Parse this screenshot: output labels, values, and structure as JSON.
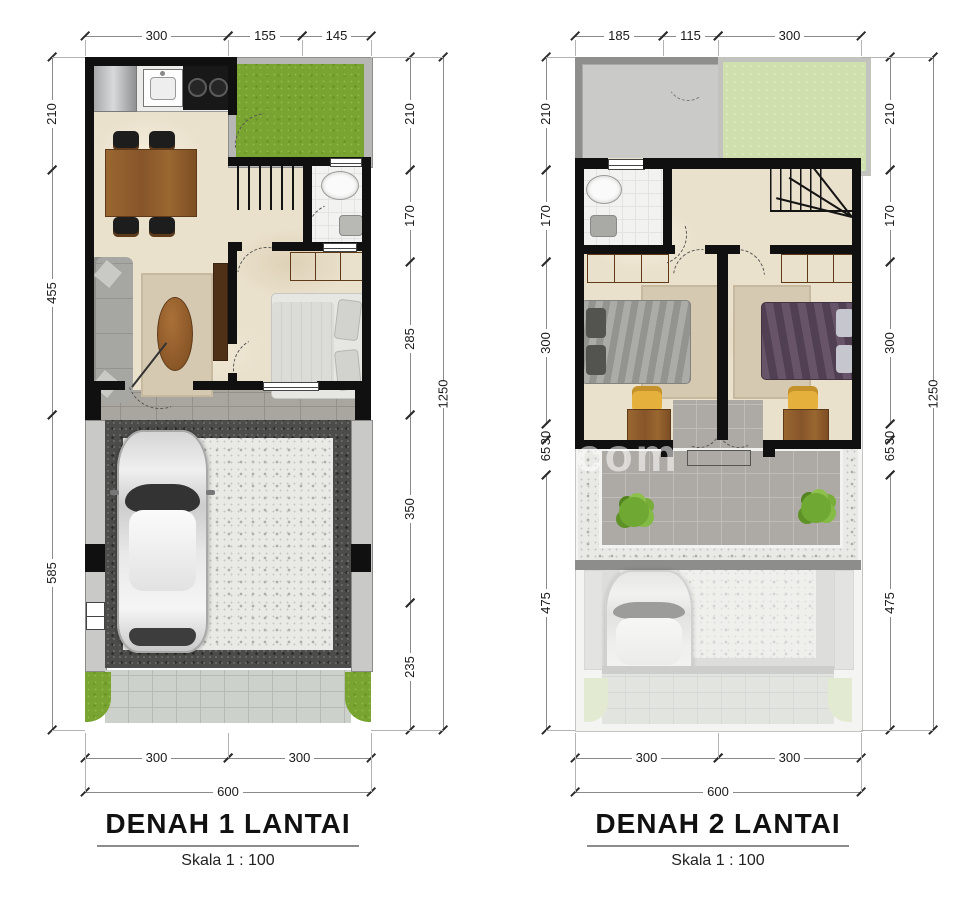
{
  "watermark": "com",
  "plans": [
    {
      "title": "DENAH 1 LANTAI",
      "scale": "Skala 1 : 100",
      "dims": {
        "top": [
          "300",
          "155",
          "145"
        ],
        "left": [
          "210",
          "455",
          "585"
        ],
        "right": [
          "210",
          "170",
          "285",
          "350",
          "235"
        ],
        "right_total": "1250",
        "bottom": [
          "300",
          "300"
        ],
        "bottom_total": "600"
      }
    },
    {
      "title": "DENAH 2 LANTAI",
      "scale": "Skala 1 : 100",
      "dims": {
        "top": [
          "185",
          "115",
          "300"
        ],
        "left": [
          "210",
          "170",
          "300",
          "30",
          "65",
          "475"
        ],
        "right": [
          "210",
          "170",
          "300",
          "30",
          "65",
          "475"
        ],
        "right_total": "1250",
        "bottom": [
          "300",
          "300"
        ],
        "bottom_total": "600"
      }
    }
  ]
}
